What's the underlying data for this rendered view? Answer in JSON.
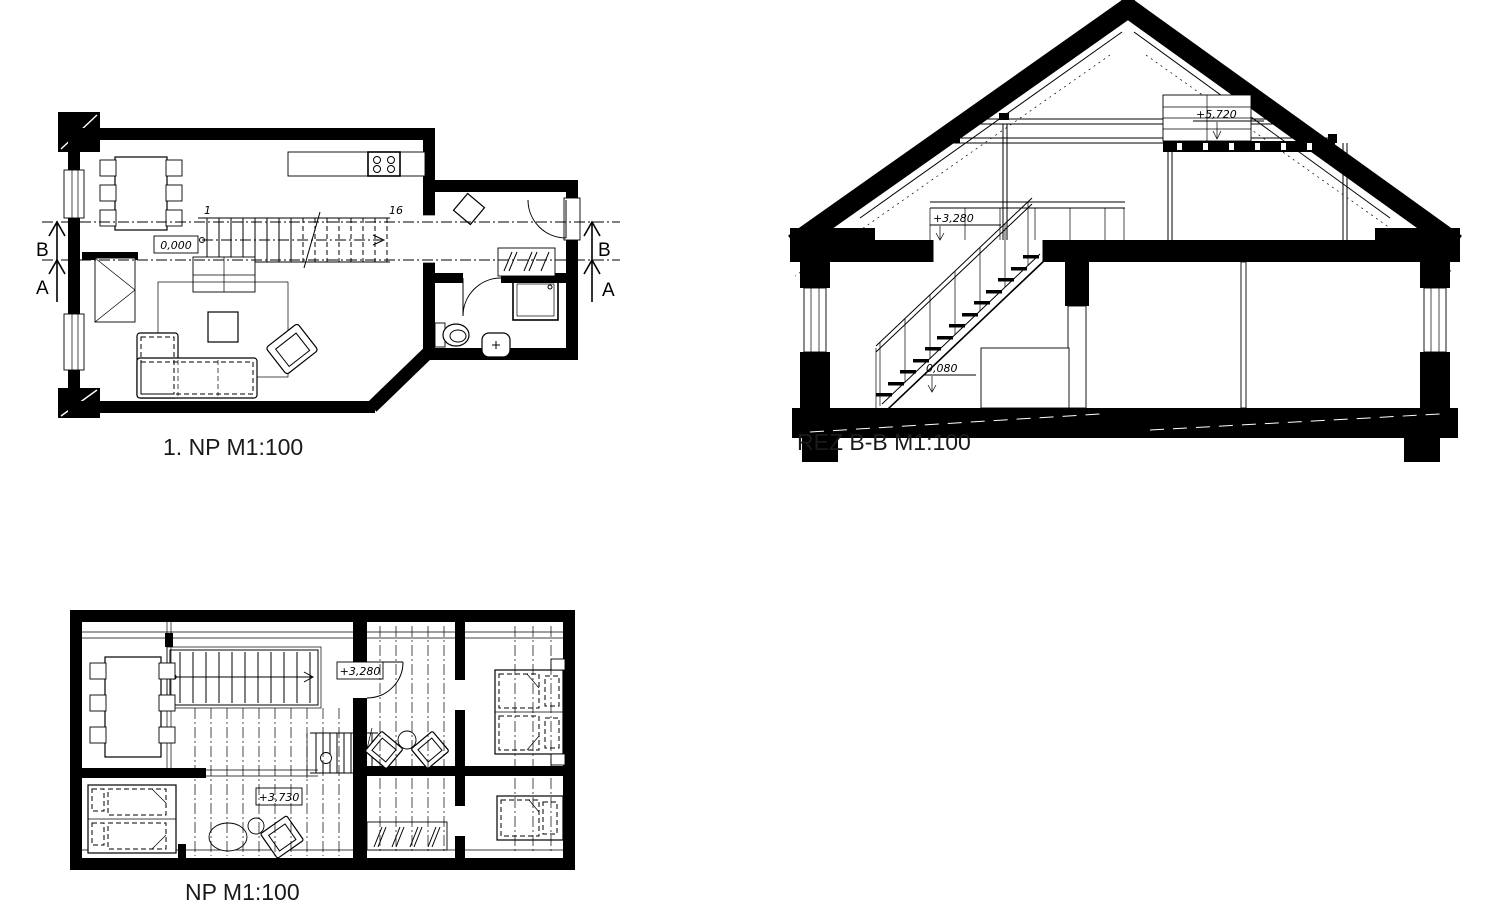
{
  "colors": {
    "ink": "#000000",
    "caption": "#1a1a1a",
    "background": "#ffffff"
  },
  "plan1": {
    "caption": "1. NP M1:100",
    "level": "0,000",
    "stair_first_step": "1",
    "stair_last_step": "16",
    "marker_b": "B",
    "marker_a": "A"
  },
  "section": {
    "caption": "REZ B-B M1:100",
    "level_loft": "+5,720",
    "level_attic": "+3,280",
    "level_ground": "0,080"
  },
  "plan2": {
    "caption": "NP M1:100",
    "level_stair": "+3,280",
    "level_floor": "+3,730"
  }
}
